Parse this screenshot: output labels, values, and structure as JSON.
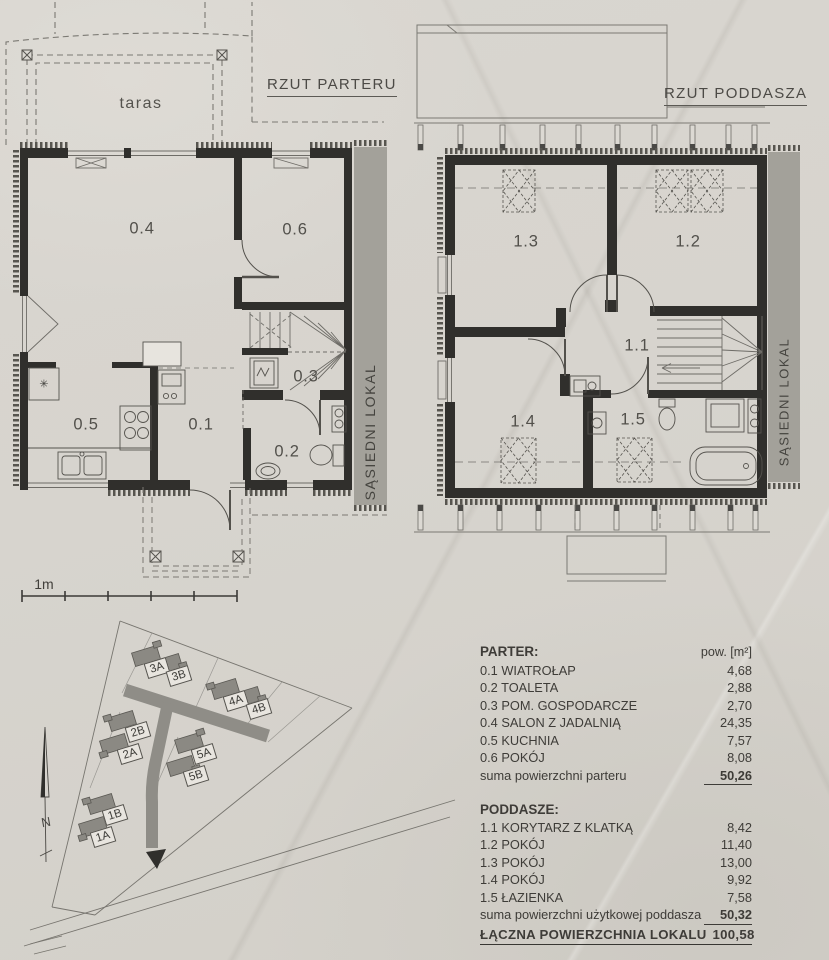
{
  "ground_floor": {
    "title": "RZUT PARTERU",
    "terrace_label": "taras",
    "neighbor_label": "SĄSIEDNI LOKAL",
    "freezer_icon": "✳",
    "rooms": {
      "r04": "0.4",
      "r06": "0.6",
      "r03": "0.3",
      "r05": "0.5",
      "r01": "0.1",
      "r02": "0.2"
    }
  },
  "attic": {
    "title": "RZUT PODDASZA",
    "neighbor_label": "SĄSIEDNI LOKAL",
    "rooms": {
      "r13": "1.3",
      "r12": "1.2",
      "r11": "1.1",
      "r14": "1.4",
      "r15": "1.5"
    }
  },
  "scale_bar": {
    "label": "1m"
  },
  "site_plan": {
    "north_label": "N",
    "lots": {
      "l3a": "3A",
      "l3b": "3B",
      "l4a": "4A",
      "l4b": "4B",
      "l2b": "2B",
      "l2a": "2A",
      "l5a": "5A",
      "l5b": "5B",
      "l1b": "1B",
      "l1a": "1A"
    }
  },
  "legend": {
    "unit_header": "pow. [m²]",
    "parter_header": "PARTER:",
    "parter_rows": [
      {
        "label": "0.1 WIATROŁAP",
        "value": "4,68"
      },
      {
        "label": "0.2 TOALETA",
        "value": "2,88"
      },
      {
        "label": "0.3 POM. GOSPODARCZE",
        "value": "2,70"
      },
      {
        "label": "0.4 SALON Z JADALNIĄ",
        "value": "24,35"
      },
      {
        "label": "0.5 KUCHNIA",
        "value": "7,57"
      },
      {
        "label": "0.6 POKÓJ",
        "value": "8,08"
      }
    ],
    "parter_sum_label": "suma powierzchni parteru",
    "parter_sum_value": "50,26",
    "poddasze_header": "PODDASZE:",
    "poddasze_rows": [
      {
        "label": "1.1 KORYTARZ Z KLATKĄ",
        "value": "8,42"
      },
      {
        "label": "1.2 POKÓJ",
        "value": "11,40"
      },
      {
        "label": "1.3 POKÓJ",
        "value": "13,00"
      },
      {
        "label": "1.4 POKÓJ",
        "value": "9,92"
      },
      {
        "label": "1.5 ŁAZIENKA",
        "value": "7,58"
      }
    ],
    "poddasze_sum_label": "suma powierzchni użytkowej poddasza",
    "poddasze_sum_value": "50,32",
    "total_label": "ŁĄCZNA POWIERZCHNIA LOKALU",
    "total_value": "100,58"
  },
  "colors": {
    "paper": "#d8d5cf",
    "wall": "#302f2c",
    "neighbor_bar": "#a3a19a",
    "road": "#8f8d87"
  }
}
